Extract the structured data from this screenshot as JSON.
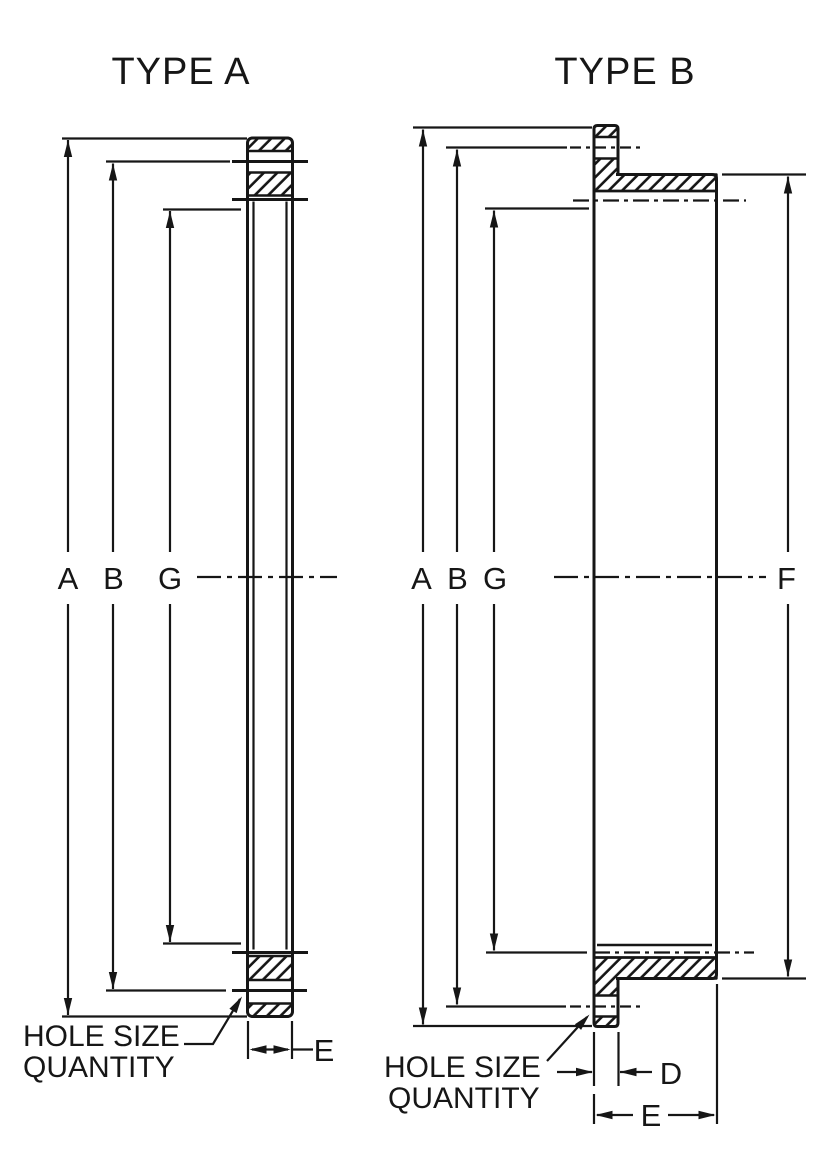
{
  "colors": {
    "ink": "#161616",
    "paper": "#ffffff"
  },
  "type_a": {
    "title": "TYPE A",
    "dims": {
      "a": "A",
      "b": "B",
      "g": "G",
      "e": "E"
    },
    "callout": {
      "line1": "HOLE SIZE",
      "line2": "QUANTITY"
    }
  },
  "type_b": {
    "title": "TYPE B",
    "dims": {
      "a": "A",
      "b": "B",
      "g": "G",
      "f": "F",
      "d": "D",
      "e": "E"
    },
    "callout": {
      "line1": "HOLE SIZE",
      "line2": "QUANTITY"
    }
  }
}
